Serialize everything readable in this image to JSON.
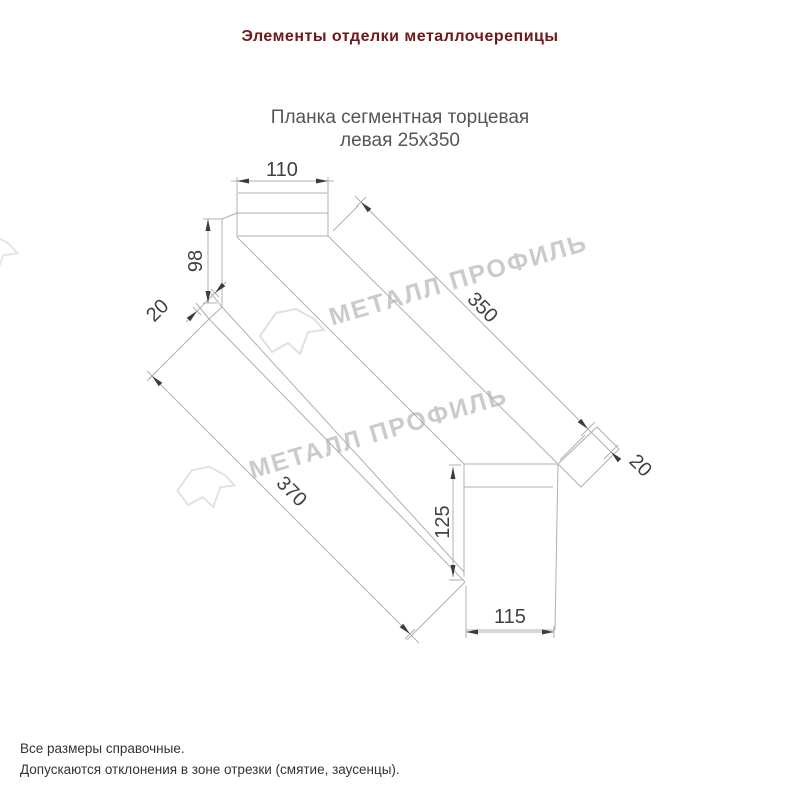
{
  "title": {
    "text": "Элементы отделки металлочерепицы",
    "color": "#6e1818"
  },
  "subtitle": {
    "line1": "Планка сегментная торцевая",
    "line2": "левая 25x350",
    "color": "#555555"
  },
  "drawing": {
    "type": "isometric technical drawing of left segmental end trim 25x350",
    "line_color": "#b0b0b0",
    "dim_text_color": "#414141",
    "arrow_color": "#3c3c3c",
    "dims": {
      "d110": "110",
      "d98": "98",
      "d20_near": "20",
      "d350": "350",
      "d370": "370",
      "d125": "125",
      "d115": "115",
      "d20_far": "20"
    }
  },
  "watermark": {
    "text": "МЕТАЛЛ ПРОФИЛЬ",
    "color": "#cbcbcb",
    "logo_color": "#e0e0e0"
  },
  "footer": {
    "line1": "Все размеры справочные.",
    "line2": "Допускаются отклонения в зоне отрезки (смятие, заусенцы).",
    "color": "#333333"
  }
}
